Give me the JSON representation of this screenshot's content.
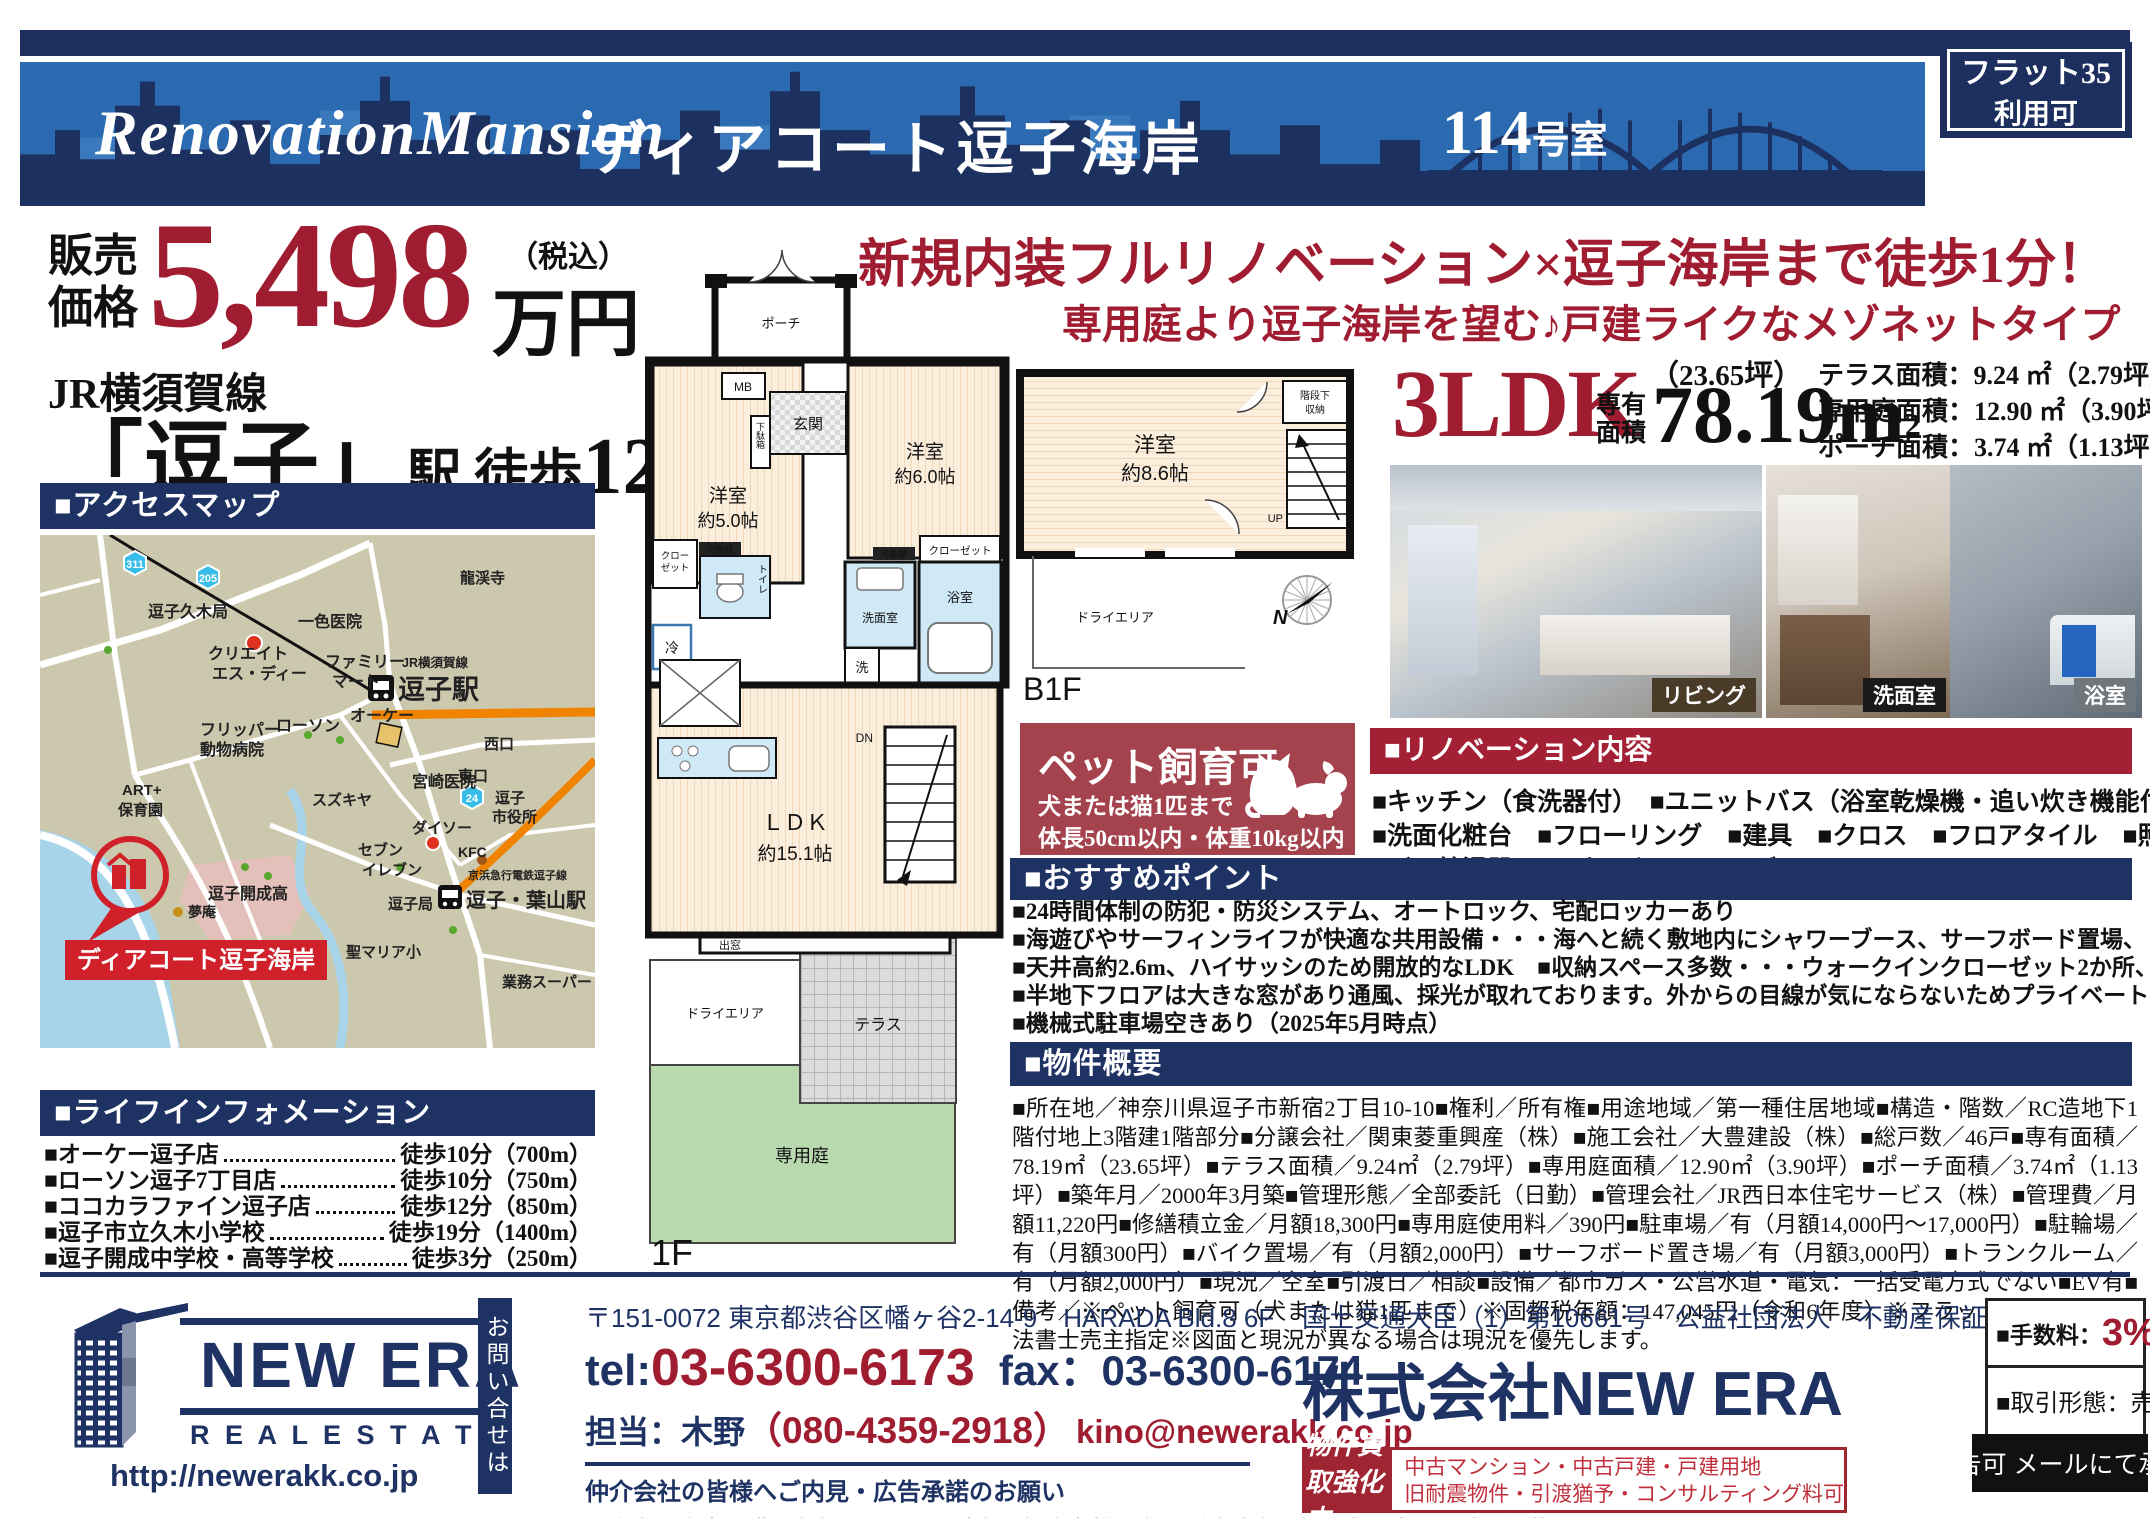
{
  "colors": {
    "navy": "#1e3264",
    "banner_blue": "#2b6ab1",
    "red": "#a01d31",
    "crimson": "#a32035",
    "pet_bg": "#a4424e",
    "map_bg": "#ccc8ad"
  },
  "header": {
    "brand": "RenovationMansion",
    "name": "ディアコート逗子海岸",
    "room_num": "114",
    "room_suffix": "号室",
    "badge_line1": "フラット35",
    "badge_line2": "利用可"
  },
  "price": {
    "label1": "販売",
    "label2": "価格",
    "amount": "5,498",
    "tax_note": "（税込）",
    "unit": "万円"
  },
  "station": {
    "line": "JR横須賀線",
    "name": "「逗子」",
    "suffix": "駅 徒歩",
    "minutes": "12",
    "minutes_unit": "分"
  },
  "access_map": {
    "title": "■アクセスマップ",
    "labels": {
      "r311": "311",
      "r205": "205",
      "r24": "24",
      "zushi_kuki": "逗子久木局",
      "isshiki": "一色医院",
      "ryukeiji": "龍渓寺",
      "create1": "クリエイト",
      "create2": "エス・ディー",
      "famima1": "ファミリー",
      "famima2": "マート",
      "jr_line": "JR横須賀線",
      "zushi_sta": "逗子駅",
      "nishiguchi": "西口",
      "higashiguchi": "東口",
      "ok_store": "オーケー",
      "lawson": "ローソン",
      "flipper1": "フリッパー",
      "flipper2": "動物病院",
      "suzukiya": "スズキヤ",
      "miyazaki": "宮崎医院",
      "shiyakusho1": "逗子",
      "shiyakusho2": "市役所",
      "daiso": "ダイソー",
      "seven1": "セブン",
      "seven2": "イレブン",
      "kfc": "KFC",
      "art1": "ART+",
      "art2": "保育園",
      "kaisei": "逗子開成高",
      "yumean": "夢庵",
      "zushikyoku": "逗子局",
      "keikyu": "京浜急行電鉄逗子線",
      "hayama_sta": "逗子・葉山駅",
      "stmaria": "聖マリア小",
      "gyomu": "業務スーパー",
      "property": "ディアコート逗子海岸"
    }
  },
  "life_info": {
    "title": "■ライフインフォメーション",
    "items": [
      {
        "name": "■オーケー逗子店",
        "distance": "徒歩10分（700m）"
      },
      {
        "name": "■ローソン逗子7丁目店",
        "distance": "徒歩10分（750m）"
      },
      {
        "name": "■ココカラファイン逗子店",
        "distance": "徒歩12分（850m）"
      },
      {
        "name": "■逗子市立久木小学校",
        "distance": "徒歩19分（1400m）"
      },
      {
        "name": "■逗子開成中学校・高等学校",
        "distance": "徒歩3分（250m）"
      }
    ]
  },
  "floorplan_1f": {
    "porch": "ポーチ",
    "mb": "MB",
    "genkan": "玄関",
    "getabako": "下駄箱",
    "bed5a": "洋室",
    "bed5b": "約5.0帖",
    "bed6a": "洋室",
    "bed6b": "約6.0帖",
    "closet_r": "クローゼット",
    "closet_l1": "クロー",
    "closet_l2": "ゼット",
    "kadou": "可動棚",
    "rei": "冷",
    "toilet": "トイレ",
    "senmen": "洗面室",
    "sen": "洗",
    "bath": "浴室",
    "ldk1": "ＬＤＫ",
    "ldk2": "約15.1帖",
    "dn": "DN",
    "demado": "出窓",
    "dry": "ドライエリア",
    "terrace": "テラス",
    "garden": "専用庭",
    "floor": "1F"
  },
  "floorplan_b1f": {
    "bed1": "洋室",
    "bed2": "約8.6帖",
    "under1": "階段下",
    "under2": "収納",
    "up": "UP",
    "dry": "ドライエリア",
    "floor": "B1F",
    "north": "N"
  },
  "headline": {
    "line1": "新規内装フルリノベーション×逗子海岸まで徒歩1分！",
    "line2": "専用庭より逗子海岸を望む♪戸建ライクなメゾネットタイプ"
  },
  "specs": {
    "layout": "3LDK",
    "area_label1": "専有",
    "area_label2": "面積",
    "tsubo": "（23.65坪）",
    "area": "78.19m",
    "area_sup": "2",
    "terrace": "テラス面積：9.24 ㎡（2.79坪）",
    "garden": "専用庭面積：12.90 ㎡（3.90坪）",
    "porch": "ポーチ面積：3.74 ㎡（1.13坪）"
  },
  "photos": {
    "living": "リビング",
    "senmen": "洗面室",
    "bath": "浴室"
  },
  "pet": {
    "title": "ペット飼育可",
    "line1": "犬または猫1匹まで",
    "line2": "体長50cm以内・体重10kg以内"
  },
  "renovation": {
    "title": "■リノベーション内容",
    "lines": [
      "■キッチン（食洗器付）　■ユニットバス（浴室乾燥機・追い炊き機能付）　■トイレ",
      "■洗面化粧台　■フローリング　■建具　■クロス　■フロアタイル　■照明器具",
      "■ガス給湯器　■ハウスクリーニング"
    ]
  },
  "points": {
    "title": "■おすすめポイント",
    "lines": [
      "■24時間体制の防犯・防災システム、オートロック、宅配ロッカーあり",
      "■海遊びやサーフィンライフが快適な共用設備・・・海へと続く敷地内にシャワーブース、サーフボード置場、トランクルームあり",
      "■天井高約2.6m、ハイサッシのため開放的なLDK　■収納スペース多数・・・ウォークインクローゼット2か所、全居室に収納付",
      "■半地下フロアは大きな窓があり通風、採光が取れております。外からの目線が気にならないためプライベート感あり♪",
      "■機械式駐車場空きあり（2025年5月時点）"
    ]
  },
  "overview": {
    "title": "■物件概要",
    "text": "■所在地／神奈川県逗子市新宿2丁目10-10■権利／所有権■用途地域／第一種住居地域■構造・階数／RC造地下1階付地上3階建1階部分■分譲会社／関東菱重興産（株）■施工会社／大豊建設（株）■総戸数／46戸■専有面積／78.19㎡（23.65坪）■テラス面積／9.24㎡（2.79坪）■専用庭面積／12.90㎡（3.90坪）■ポーチ面積／3.74㎡（1.13坪）■築年月／2000年3月築■管理形態／全部委託（日勤）■管理会社／JR西日本住宅サービス（株）■管理費／月額11,220円■修繕積立金／月額18,300円■専用庭使用料／390円■駐車場／有（月額14,000円～17,000円）■駐輪場／有（月額300円）■バイク置場／有（月額2,000円）■サーフボード置き場／有（月額3,000円）■トランクルーム／有（月額2,000円）■現況／空室■引渡日／相談■設備／都市ガス・公営水道・電気：一括受電方式でない■EV有■備考／※ペット飼育可（犬または猫1匹まで）※固都税年額：147,045円（令和6年度）※フラット35利用可※司法書士売主指定※図面と現況が異なる場合は現況を優先します。"
  },
  "footer": {
    "logo_name": "NEW ERA",
    "logo_sub": "R E A L   E S T A T E",
    "url": "http://newerakk.co.jp",
    "inquiry_vertical": "お問い合せは",
    "address": "〒151-0072 東京都渋谷区幡ヶ谷2-14-9　HARADA Bld.8 6F",
    "tel_label": "tel:",
    "tel": "03-6300-6173",
    "fax": "fax：03-6300-6174",
    "contact_person": "担当：木野",
    "mobile": "（080-4359-2918）",
    "email": "kino@newerakk.co.jp",
    "notice_title": "仲介会社の皆様へご内見・広告承諾のお願い",
    "notice_line1": "ご案内・広告承諾は名刺もしくは御社名・担当者様氏名・ご連絡先・物件名号室・日時を記載の上",
    "notice_email": "kino@newerakk.co.jp",
    "notice_line2": "へご連絡お願いします。担当からご返答させて頂きます。",
    "license": "国土交通大臣（1）第10661号　公益社団法人　不動産保証協会",
    "company": "株式会社NEW ERA",
    "kaitori_label": "物件買取強化中",
    "kaitori_line1": "中古マンション・中古戸建・戸建用地",
    "kaitori_line2": "旧耐震物件・引渡猶予・コンサルティング料可",
    "fee_label": "■手数料：",
    "fee_value": "3%",
    "fee_tax": "（税込）",
    "deal_type": "■取引形態：売主",
    "ad_ok": "広告可 メールにて承諾"
  }
}
